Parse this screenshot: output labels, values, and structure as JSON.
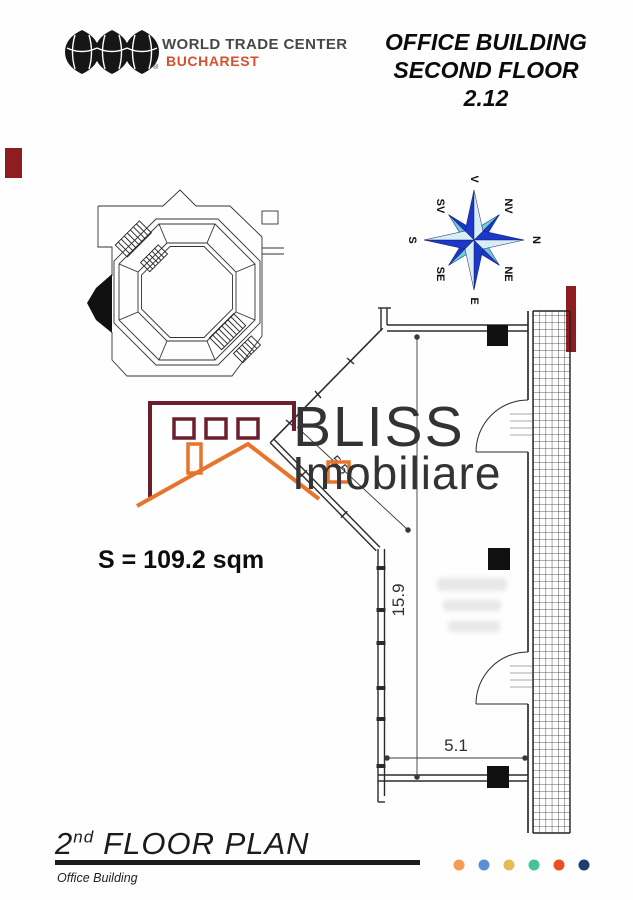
{
  "header": {
    "logo": {
      "line1": "WORLD TRADE CENTER",
      "line2": "BUCHAREST",
      "reg": "®"
    },
    "title": {
      "line1": "OFFICE BUILDING",
      "line2": "SECOND FLOOR",
      "line3": "2.12"
    }
  },
  "compass": {
    "labels": [
      "V",
      "NV",
      "N",
      "NE",
      "E",
      "SE",
      "S",
      "SV"
    ]
  },
  "watermark": {
    "line1": "BLISS",
    "line2": "Imobiliare"
  },
  "plan": {
    "area_label": "S = 109.2 sqm",
    "dims": {
      "vertical": "15.9",
      "horizontal": "5.1",
      "diagonal": "5.5"
    }
  },
  "footer": {
    "title_number": "2",
    "title_sup": "nd",
    "title_rest": "FLOOR PLAN",
    "subtitle": "Office Building",
    "dot_colors": [
      "#F59B52",
      "#5B8FD4",
      "#E3BC56",
      "#45C49B",
      "#E8501F",
      "#1C3D6E"
    ]
  },
  "colors": {
    "brand_orange": "#D4512F",
    "border_red": "#8E1D20",
    "logo_maroon": "#6B1F2E",
    "logo_orange": "#E8742C",
    "compass_dark": "#1D38C8",
    "compass_light": "#6FCBD9"
  }
}
